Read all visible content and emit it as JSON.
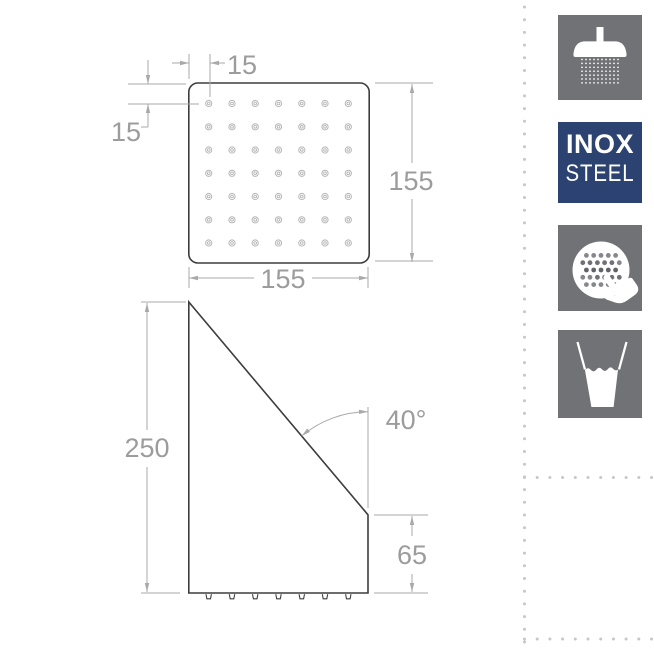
{
  "drawing": {
    "colors": {
      "outline": "#3d3d3f",
      "dimension": "#a9a9ab",
      "dimension_text": "#9c9c9e",
      "nozzle_ring": "#b6b6b8"
    },
    "top_view": {
      "dim_top_offset": "15",
      "dim_left_offset": "15",
      "dim_width": "155",
      "dim_height": "155",
      "nozzle_rows": 7,
      "nozzle_cols": 7
    },
    "side_view": {
      "dim_height": "250",
      "dim_angle": "40°",
      "dim_outlet_depth": "65",
      "outlet_nozzles": 7
    }
  },
  "sidebar": {
    "separator_dot_color": "#c7c7c9",
    "tile_color": "#717276",
    "icons": [
      {
        "name": "overhead-shower-icon"
      },
      {
        "name": "inox-steel-badge",
        "line1": "INOX",
        "line2": "STEEL",
        "color": "#2c4270"
      },
      {
        "name": "rub-clean-spray-face-icon"
      },
      {
        "name": "water-glass-icon"
      }
    ]
  }
}
